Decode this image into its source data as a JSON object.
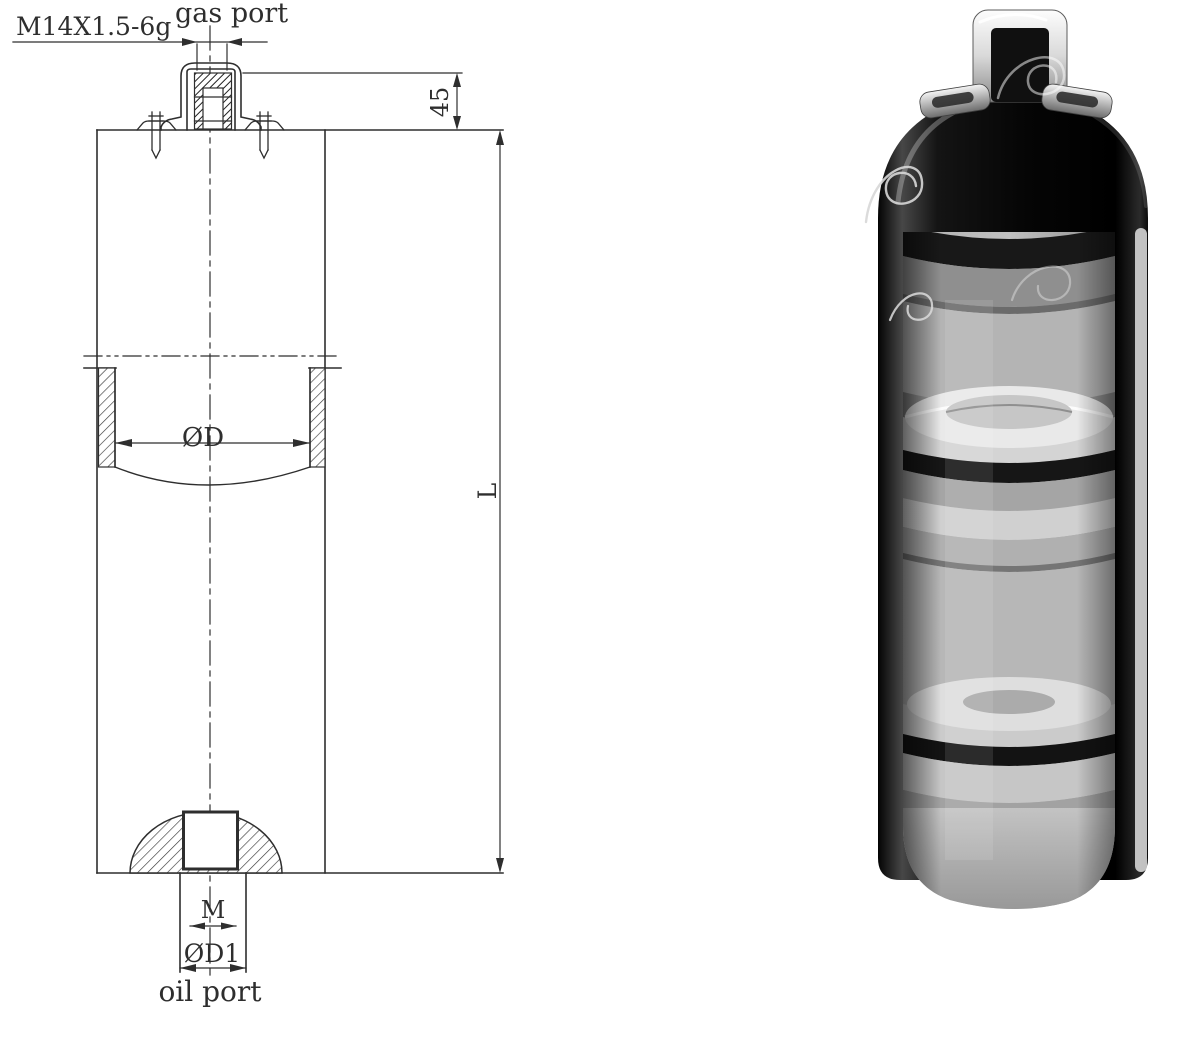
{
  "drawing": {
    "line_color": "#2e2e2e",
    "labels": {
      "thread_spec": "M14X1.5-6g",
      "gas_port": "gas port",
      "valve_height": "45",
      "bore_diameter": "ØD",
      "total_length": "L",
      "oil_thread": "M",
      "oil_port_diameter": "ØD1",
      "oil_port": "oil port"
    }
  },
  "render": {
    "colors": {
      "shell": "#0d0d0d",
      "bore": "#b2b2b2",
      "piston": "#e9e9e9",
      "seal": "#141414",
      "bracket_face": "#efefef",
      "cut_face": "#d0d0d0"
    }
  }
}
